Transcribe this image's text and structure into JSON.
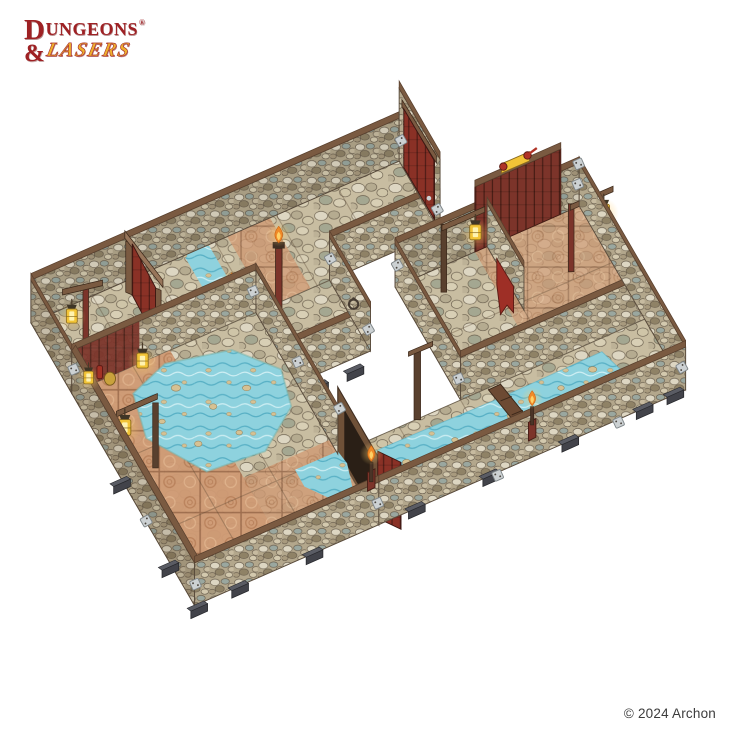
{
  "brand": {
    "initial": "D",
    "word1_rest": "UNGEONS",
    "registered": "®",
    "ampersand": "&",
    "word2": "LASERS"
  },
  "footer": {
    "copyright": "© 2024 Archon"
  },
  "product_image": {
    "description": "Dungeons & Lasers modular dungeon terrain set: stone-walled corridors and rooms with cobblestone and terracotta floors, a blue river and pond, red wooden doors, hanging lanterns, torches and dark grey base clips, photographed on white",
    "palette": {
      "logo_red": "#9e2124",
      "logo_gold": "#eeb02e",
      "copyright_gray": "#3c3c3c",
      "wood": "#7a5a41",
      "wood_dark": "#59402e",
      "wood_light": "#97755a",
      "stone_base": "#b3a78c",
      "stone_light": "#ddd6c2",
      "stone_gray": "#9aa79f",
      "stone_dark": "#6e6351",
      "floor_base": "#c8bda1",
      "terracotta": "#cf9a74",
      "terracotta_dark": "#9c6a4a",
      "water": "#8ed2de",
      "water_dark": "#58b0c5",
      "water_light": "#cdeef3",
      "maroon": "#7c342a",
      "door_red": "#8a3126",
      "door_dark": "#4f1d16",
      "lantern_gold": "#f2c437",
      "flame_orange": "#f08a28",
      "flame_core": "#ffd166",
      "metal": "#ccd1d3",
      "foot_gray": "#42434a",
      "sand_stone": "#d6c193"
    }
  }
}
